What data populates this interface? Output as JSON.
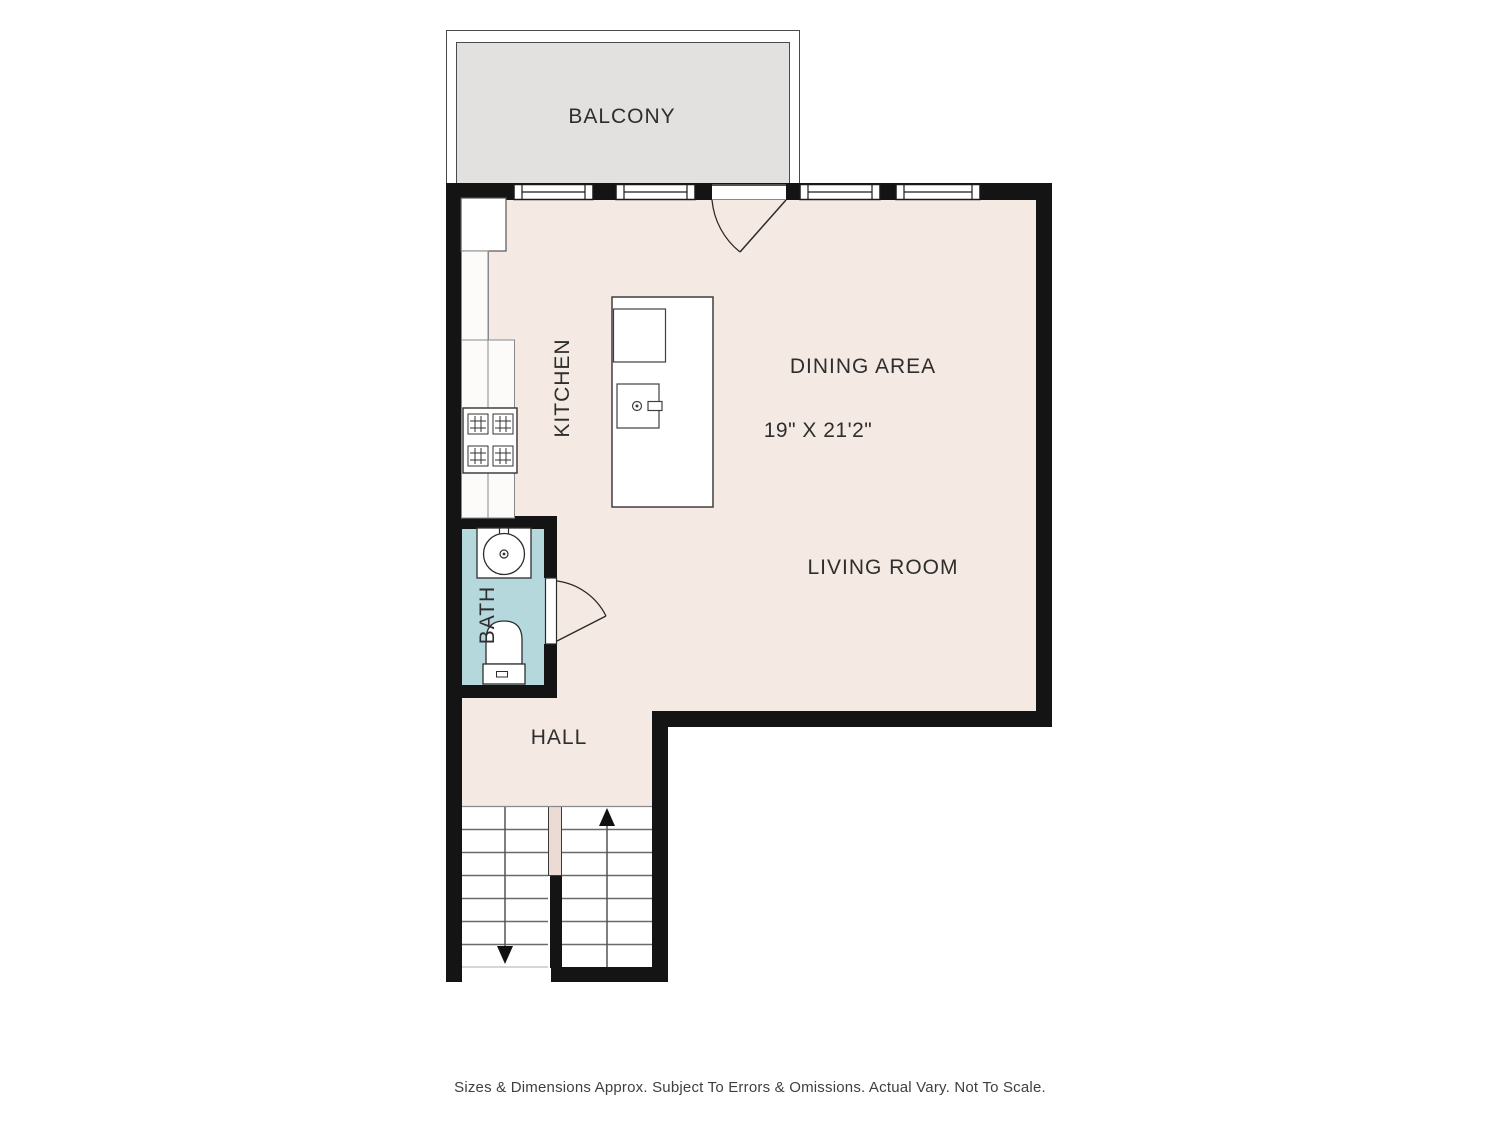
{
  "plan": {
    "type": "floor-plan",
    "rooms": {
      "balcony": {
        "label": "BALCONY"
      },
      "kitchen": {
        "label": "KITCHEN"
      },
      "dining": {
        "label": "DINING AREA",
        "dimensions": "19\" X 21'2\""
      },
      "living": {
        "label": "LIVING ROOM"
      },
      "bath": {
        "label": "BATH"
      },
      "hall": {
        "label": "HALL"
      }
    },
    "footer": {
      "disclaimer": "Sizes & Dimensions Approx. Subject To Errors & Omissions. Actual Vary. Not To Scale."
    },
    "icons": {
      "window-icon": "double-pane-window",
      "balcony-door-icon": "door-swing-arc",
      "bath-door-icon": "door-swing-arc",
      "stove-icon": "4-burner-cooktop",
      "island-sink-icon": "sink-with-faucet",
      "bath-sink-icon": "round-basin-sink",
      "toilet-icon": "toilet-top-view",
      "stairs-up-arrow-icon": "arrow-up",
      "stairs-down-arrow-icon": "arrow-down"
    },
    "colors": {
      "floor": "#f5e9e3",
      "balcony_floor": "#e2e1e0",
      "bath_floor": "#b5d8dc",
      "wall": "#141414",
      "fixture_outline": "#3c3c3c",
      "stair_line": "#6a6a6a",
      "label_text": "#2e2e2e"
    }
  }
}
